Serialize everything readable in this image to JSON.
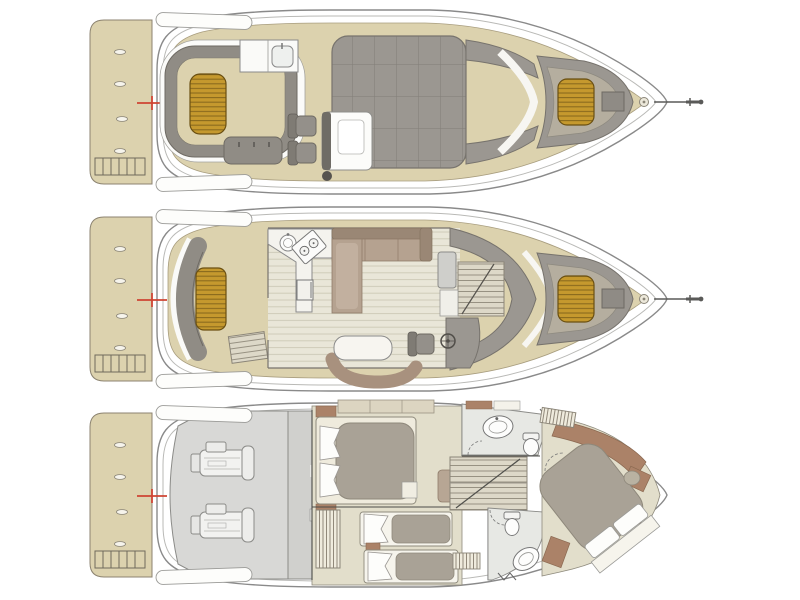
{
  "figure": {
    "type": "yacht-deck-plans",
    "view": "top-down-floorplan",
    "orientation": "bow-right",
    "deck_count": 3,
    "decks": [
      {
        "id": "flybridge",
        "features": [
          "swim-platform",
          "boarding-ladder",
          "mooring-cleats",
          "registration-cross",
          "stern-lockers",
          "u-shaped-lounge",
          "teak-table",
          "wet-bar-sink",
          "bench-seat",
          "helm-seats",
          "helm-console",
          "quilted-sunpad",
          "windshield-walkway",
          "bow-lounge",
          "bow-teak-table",
          "bow-step",
          "anchor-windlass",
          "anchor-sprit"
        ]
      },
      {
        "id": "main-deck",
        "features": [
          "swim-platform",
          "boarding-ladder",
          "mooring-cleats",
          "registration-cross",
          "stern-lockers",
          "transom-bench",
          "teak-table",
          "cockpit-steps",
          "galley-counter",
          "galley-sink",
          "galley-stove",
          "galley-fridge",
          "plank-flooring",
          "l-shaped-sofa",
          "chaise-lounge",
          "tv-cabinet",
          "companionway-stairs",
          "dinette-table",
          "dinette-bench",
          "helm-seat",
          "steering-wheel",
          "windshield-console",
          "bow-lounge",
          "bow-teak-table",
          "bow-step",
          "anchor-windlass",
          "anchor-sprit"
        ]
      },
      {
        "id": "lower-deck",
        "features": [
          "swim-platform",
          "boarding-ladder",
          "mooring-cleats",
          "registration-cross",
          "stern-lockers",
          "engine-room",
          "engines",
          "tank-bulkhead",
          "mid-cabin-double-bed",
          "pillows",
          "closet",
          "wardrobe-hangers",
          "twin-beds",
          "central-stairs",
          "aft-head",
          "toilet",
          "sink",
          "shower-door",
          "fwd-head",
          "vip-island-bed",
          "vip-pouf",
          "vip-shelving",
          "hanging-lockers"
        ]
      }
    ]
  },
  "palette": {
    "background": "#ffffff",
    "hull_stroke": "#8a8a8a",
    "sheer_stroke": "#b9b9b6",
    "deck_tan": "#dcd2ae",
    "deck_tan_stroke": "#a89d7e",
    "pad_gray": "#9b9791",
    "pad_gray_stroke": "#76726c",
    "seat_gray": "#908c85",
    "seat_inner": "#b5ae9f",
    "teak_gold": "#c5992e",
    "teak_stripe": "#8a6a1d",
    "wood_floor": "#e9e6d8",
    "cushion_brown": "#b5a290",
    "cushion_brown_dark": "#9a8775",
    "floor_beige": "#e2decb",
    "engine_gray": "#d8d8d6",
    "bath_gray": "#e7e8e4",
    "bed_gray": "#a9a296",
    "linen_white": "#fdfdfb",
    "wood_brown": "#ab8268",
    "stair_tread": "#ddd8c8",
    "red_mark": "#cf4433"
  }
}
